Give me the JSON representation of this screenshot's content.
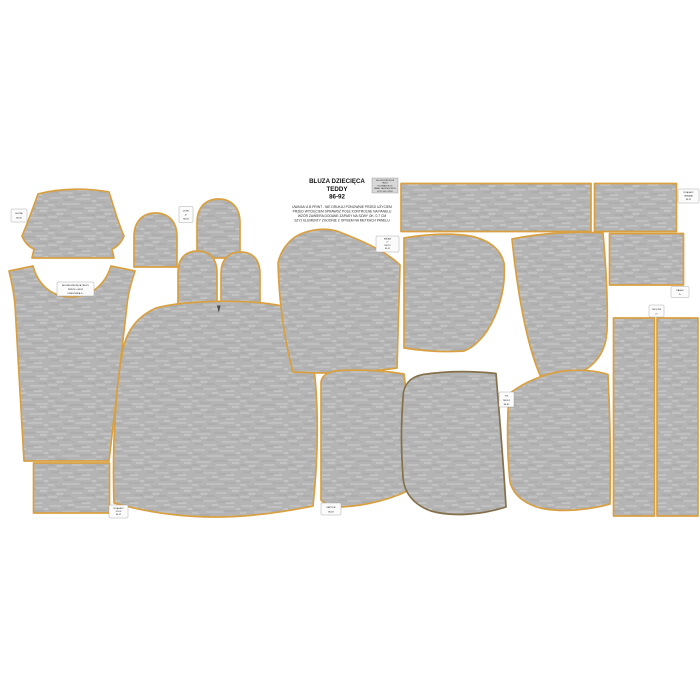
{
  "sheet": {
    "title_line1": "BLUZA DZIECIĘCA",
    "title_line2": "TEDDY",
    "title_line3": "86-92",
    "note_line1": "UWAGA! A B PRINT - NIE DRUKUJ PONOWNIE PRZED UŻYCIEM",
    "note_line2": "PRZED WYCIĘCIEM SPRAWDŹ POLE KONTROLNE NA PANELU",
    "note_line3": "WZÓR ZAWIERA DODANE ZAPASY NA SZWY OK. 0,7 CM",
    "note_line4": "SZYJ ELEMENTY ZGODNIE Z OPISEM NA METKACH PANELU"
  },
  "colors": {
    "background": "#ffffff",
    "fabric_base": "#b4b4b4",
    "fabric_streak_light": "#cdcdcd",
    "fabric_streak_dark": "#a2a2a2",
    "outline_orange": "#d9a041",
    "outline_dark": "#84714a",
    "tag_background": "#fbfbfb",
    "info_tag_background": "#d8d8d8"
  },
  "tags": [
    {
      "lines": [
        "BLUZA",
        "86-92"
      ]
    },
    {
      "lines": [
        "BLUZA DZIECIĘCA TEDDY",
        "PRZÓD • 86-92",
        "DRESÓWKA 1×"
      ]
    },
    {
      "lines": [
        "UCHO",
        "4×",
        "86-92"
      ]
    },
    {
      "lines": [
        "BLUZA DZIECIĘCA",
        "TEDDY",
        "ROZMIAR 86-92",
        "PANEL NA DRESÓWCE",
        "SZYJ WG OPISU"
      ]
    },
    {
      "lines": [
        "RĘKAW",
        "2×",
        "TEDDY",
        "86-92"
      ]
    },
    {
      "lines": [
        "ŚCIĄGACZ",
        "RĘKAWA",
        "86-92"
      ]
    },
    {
      "lines": [
        "PASEK",
        "2×"
      ]
    },
    {
      "lines": [
        "TROCZKI",
        "2×"
      ]
    },
    {
      "lines": [
        "TYŁ",
        "TEDDY",
        "86-92"
      ]
    },
    {
      "lines": [
        "KAPTUR",
        "86-92"
      ]
    },
    {
      "lines": [
        "ŚCIĄGACZ",
        "DOŁU",
        "86-92"
      ]
    }
  ]
}
